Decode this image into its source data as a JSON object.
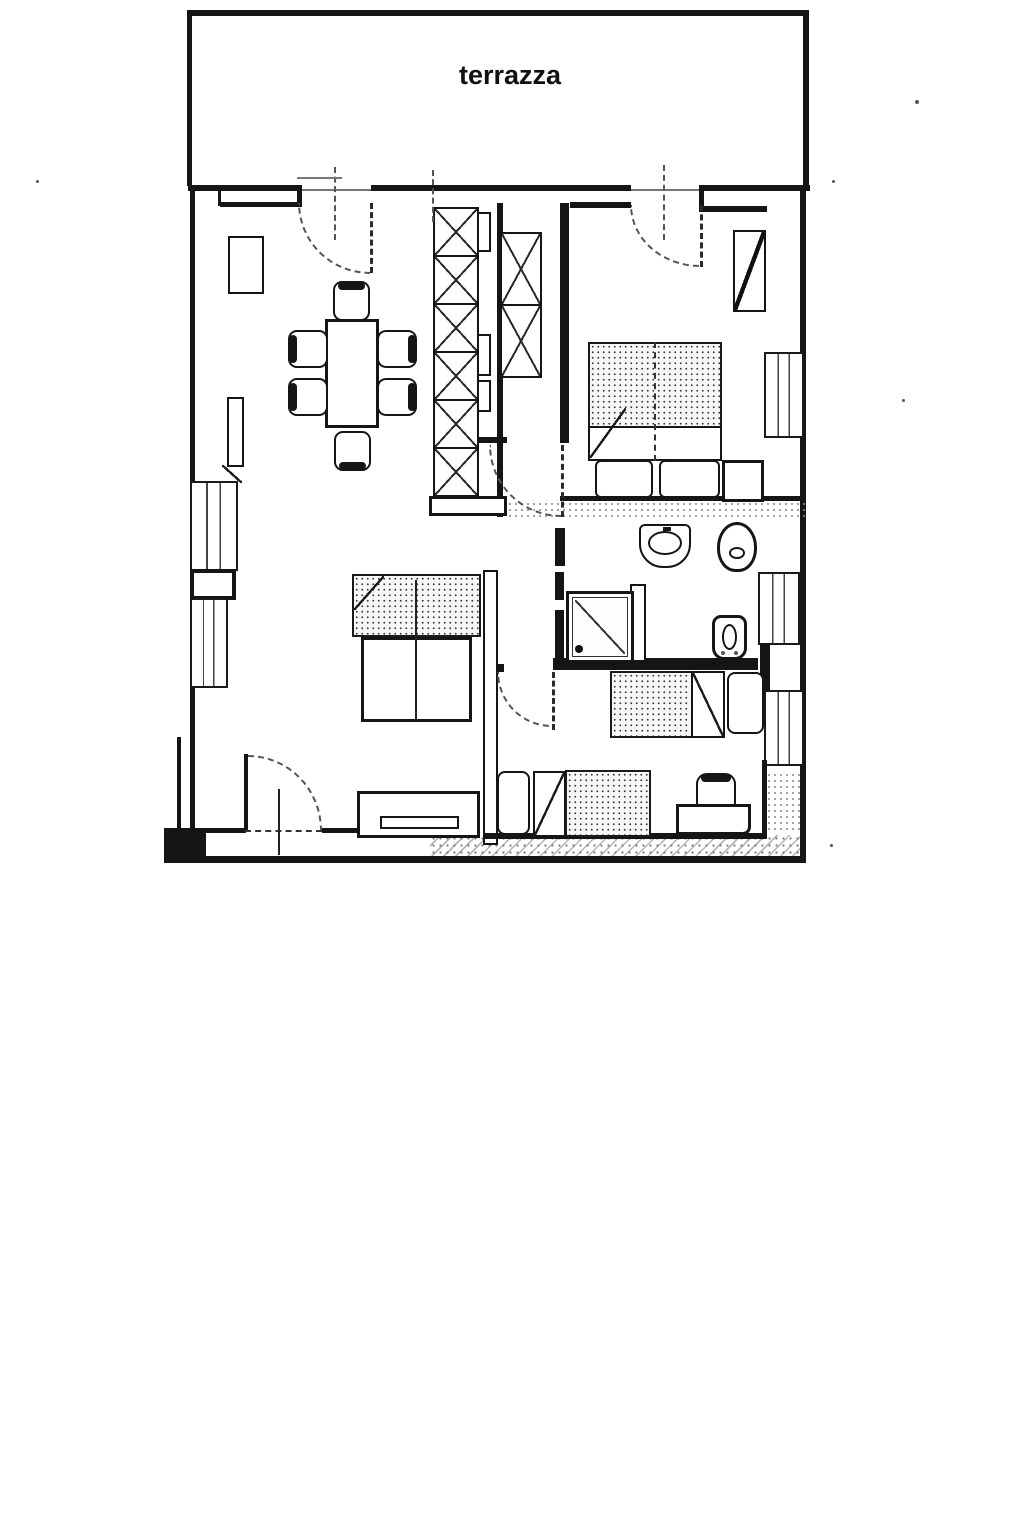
{
  "plan": {
    "terrace_label": "terrazza",
    "colors": {
      "paper": "#ffffff",
      "ink": "#151515",
      "scan_gray": "#777777"
    }
  }
}
